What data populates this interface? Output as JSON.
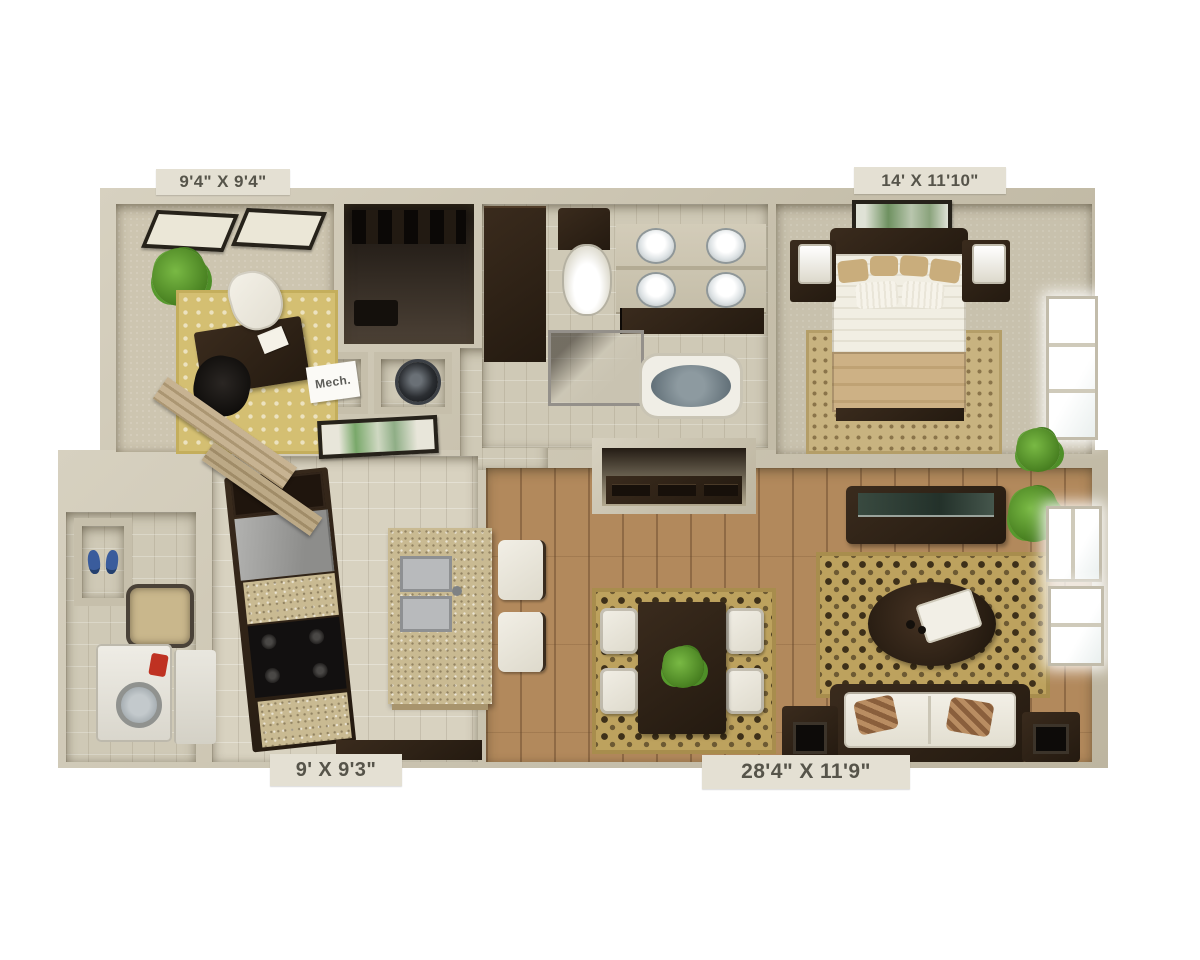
{
  "title": "3D apartment floor plan",
  "rooms": [
    {
      "id": "den",
      "label": "9'4\" X 9'4\""
    },
    {
      "id": "bedroom",
      "label": "14' X 11'10\""
    },
    {
      "id": "kitchen",
      "label": "9' X 9'3\""
    },
    {
      "id": "living-dining",
      "label": "28'4\" X 11'9\""
    }
  ],
  "signs": {
    "mech": "Mech."
  },
  "colors": {
    "background": "#ffffff",
    "wall": "#cbc4b2",
    "wood_floor": "#b2895c",
    "tile_floor": "#d8d2c0",
    "carpet": "#cdc5b0",
    "rug_gold": "#d4bf72",
    "rug_damask": "#bda25e",
    "dark_wood": "#2e2218",
    "plant_green": "#5a9a2e",
    "label_bg": "#e4e0d3",
    "label_text": "#56544a"
  }
}
